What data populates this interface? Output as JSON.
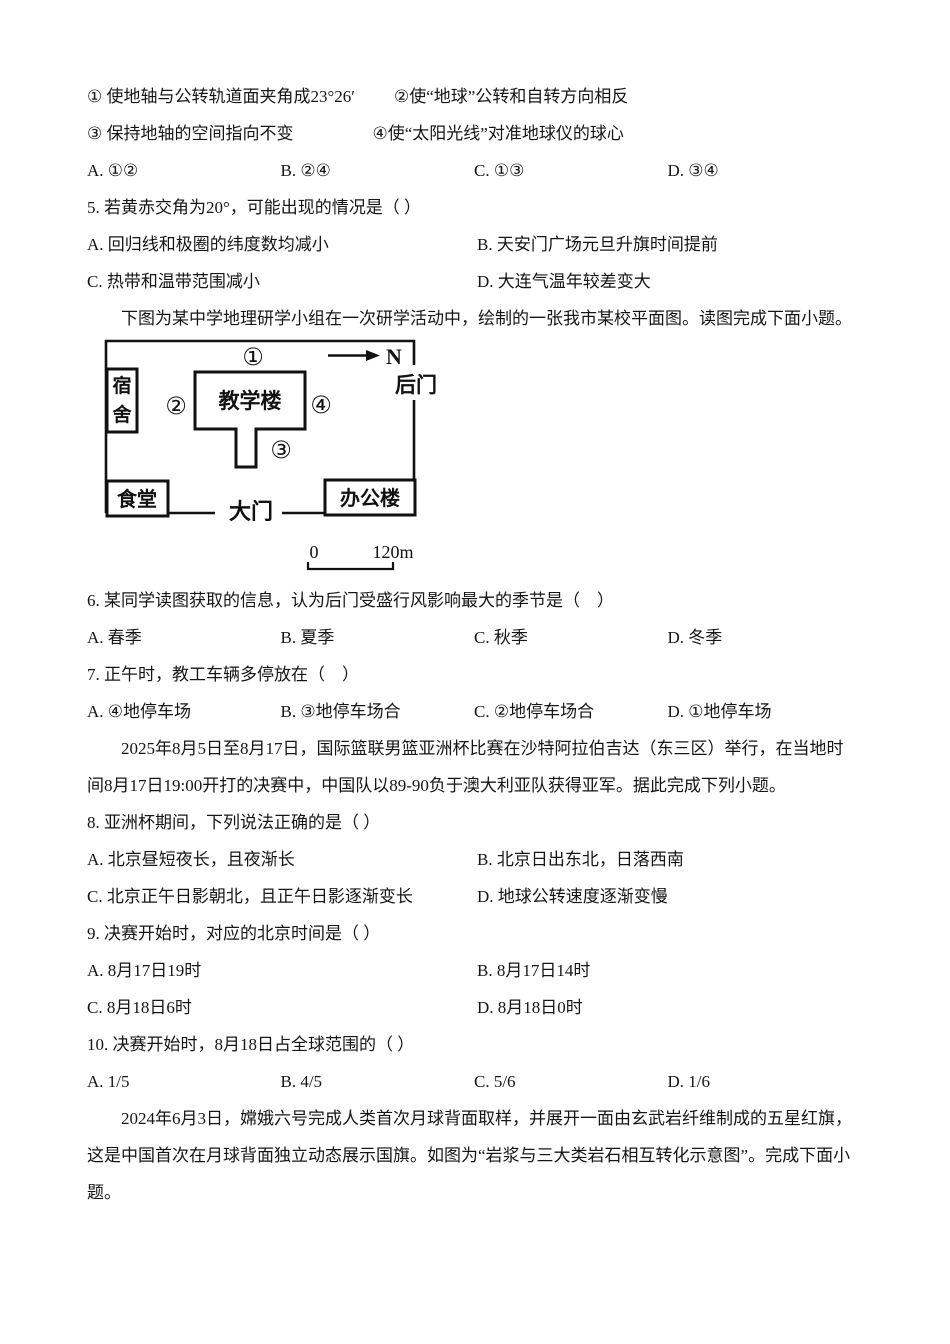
{
  "q4_tail": {
    "row1_left": "① 使地轴与公转轨道面夹角成23°26′",
    "row1_right": "②使“地球”公转和自转方向相反",
    "row2_left": "③ 保持地轴的空间指向不变",
    "row2_right": "④使“太阳光线”对准地球仪的球心",
    "options": [
      "A. ①②",
      "B. ②④",
      "C. ①③",
      "D. ③④"
    ]
  },
  "q5": {
    "stem": "5. 若黄赤交角为20°，可能出现的情况是（ ）",
    "options": [
      "A. 回归线和极圈的纬度数均减小",
      "B. 天安门广场元旦升旗时间提前",
      "C. 热带和温带范围减小",
      "D. 大连气温年较差变大"
    ]
  },
  "map_section": {
    "intro": "下图为某中学地理研学小组在一次研学活动中，绘制的一张我市某校平面图。读图完成下面小题。",
    "map": {
      "marker1": "①",
      "marker2": "②",
      "marker3": "③",
      "marker4": "④",
      "dormitory_char1": "宿",
      "dormitory_char2": "舍",
      "teaching_building": "教学楼",
      "canteen": "食堂",
      "office_building": "办公楼",
      "main_gate": "大门",
      "back_gate": "后门",
      "north": "N",
      "scale_zero": "0",
      "scale_end": "120m"
    }
  },
  "q6": {
    "stem": "6. 某同学读图获取的信息，认为后门受盛行风影响最大的季节是（　）",
    "options": [
      "A. 春季",
      "B. 夏季",
      "C. 秋季",
      "D. 冬季"
    ]
  },
  "q7": {
    "stem": "7. 正午时，教工车辆多停放在（　）",
    "options": [
      "A. ④地停车场",
      "B. ③地停车场合",
      "C. ②地停车场合",
      "D. ①地停车场"
    ]
  },
  "basketball_section": {
    "line1": "2025年8月5日至8月17日，国际篮联男篮亚洲杯比赛在沙特阿拉伯吉达（东三区）举行，在当地时",
    "line2": "间8月17日19:00开打的决赛中，中国队以89-90负于澳大利亚队获得亚军。据此完成下列小题。"
  },
  "q8": {
    "stem": "8. 亚洲杯期间，下列说法正确的是（ ）",
    "options": [
      "A. 北京昼短夜长，且夜渐长",
      "B. 北京日出东北，日落西南",
      "C. 北京正午日影朝北，且正午日影逐渐变长",
      "D. 地球公转速度逐渐变慢"
    ]
  },
  "q9": {
    "stem": "9. 决赛开始时，对应的北京时间是（ ）",
    "options": [
      "A. 8月17日19时",
      "B. 8月17日14时",
      "C. 8月18日6时",
      "D. 8月18日0时"
    ]
  },
  "q10": {
    "stem": "10. 决赛开始时，8月18日占全球范围的（ ）",
    "options": [
      "A. 1/5",
      "B. 4/5",
      "C. 5/6",
      "D. 1/6"
    ]
  },
  "moon_section": {
    "line1": "2024年6月3日，嫦娥六号完成人类首次月球背面取样，并展开一面由玄武岩纤维制成的五星红旗，",
    "line2": "这是中国首次在月球背面独立动态展示国旗。如图为“岩浆与三大类岩石相互转化示意图”。完成下面小",
    "line3": "题。"
  }
}
